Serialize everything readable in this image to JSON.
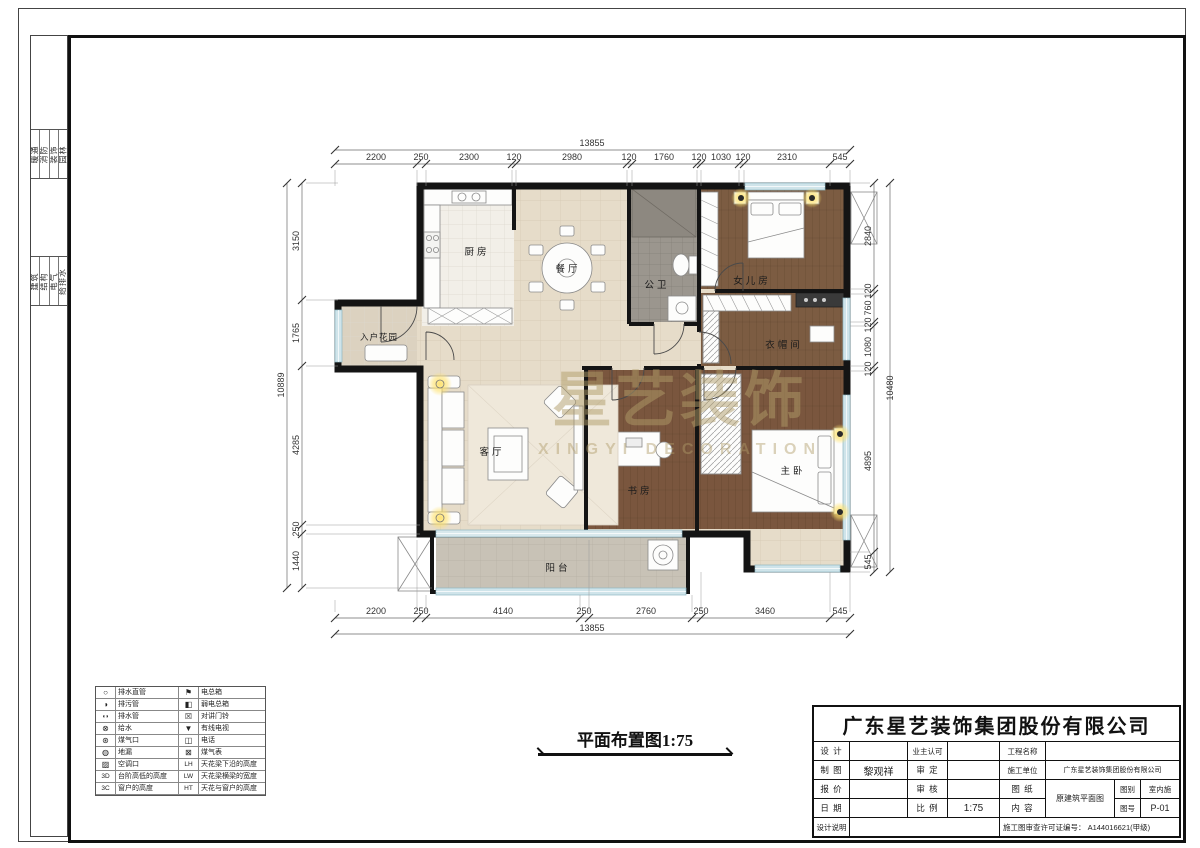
{
  "page": {
    "title_caption": "平面布置图1:75"
  },
  "watermark": {
    "cn": "星艺装饰",
    "en": "XINGYI DECORATION"
  },
  "rooms": {
    "kitchen": "厨房",
    "dining": "餐厅",
    "bath": "公卫",
    "girls_room": "女儿房",
    "cloak": "衣帽间",
    "master": "主卧",
    "study": "书房",
    "living": "客厅",
    "entry_garden": "入户花园",
    "balcony": "阳台"
  },
  "dims": {
    "top": {
      "total": "13855",
      "segments": [
        "2200",
        "250",
        "2300",
        "120",
        "2980",
        "120",
        "1760",
        "120",
        "1030",
        "120",
        "2310",
        "545"
      ]
    },
    "bottom": {
      "total": "13855",
      "segments": [
        "2200",
        "250",
        "4140",
        "250",
        "2760",
        "250",
        "3460",
        "545"
      ]
    },
    "left": {
      "total": "10889",
      "segments": [
        "3150",
        "1765",
        "4285",
        "250",
        "1440"
      ]
    },
    "right": {
      "total": "10480",
      "segments": [
        "2840",
        "120",
        "760",
        "120",
        "1080",
        "120",
        "4895",
        "545"
      ]
    }
  },
  "legend": {
    "left": [
      {
        "icon": "○",
        "label": "排水直管"
      },
      {
        "icon": "◑",
        "label": "排污管"
      },
      {
        "icon": "◖◗",
        "label": "排水管"
      },
      {
        "icon": "⊗",
        "label": "给水"
      },
      {
        "icon": "⊛",
        "label": "煤气口"
      },
      {
        "icon": "◍",
        "label": "地漏"
      },
      {
        "icon": "▨",
        "label": "空调口"
      },
      {
        "icon": "3D",
        "label": "台阶高低的高度"
      },
      {
        "icon": "3C",
        "label": "窗户的高度"
      }
    ],
    "right": [
      {
        "icon": "⚑",
        "label": "电总箱"
      },
      {
        "icon": "◧",
        "label": "弱电总箱"
      },
      {
        "icon": "☒",
        "label": "对讲门铃"
      },
      {
        "icon": "▼",
        "label": "有线电视"
      },
      {
        "icon": "◫",
        "label": "电话"
      },
      {
        "icon": "⊠",
        "label": "煤气表"
      },
      {
        "icon": "LH",
        "label": "天花梁下沿的高度"
      },
      {
        "icon": "LW",
        "label": "天花梁横梁的宽度"
      },
      {
        "icon": "HT",
        "label": "天花与窗户的高度"
      }
    ]
  },
  "frame_strip": {
    "group1": [
      "暖通",
      "消防",
      "装饰",
      "园林"
    ],
    "group2": [
      "建筑",
      "结构",
      "电气",
      "给排水"
    ]
  },
  "title_block": {
    "company": "广东星艺装饰集团股份有限公司",
    "labels": {
      "design": "设 计",
      "draft": "制 图",
      "quote": "报 价",
      "date": "日 期",
      "notes": "设计说明",
      "owner_ok": "业主认可",
      "approve": "审 定",
      "check": "审 核",
      "scale": "比 例",
      "project": "工程名称",
      "builder": "施工单位",
      "sheet": "图 纸",
      "content": "内 容",
      "category": "图别",
      "number": "图号"
    },
    "values": {
      "draft_name": "黎观祥",
      "scale": "1:75",
      "builder": "广东星艺装饰集团股份有限公司",
      "sheet_content": "原建筑平面图",
      "category": "室内施",
      "number": "P-01",
      "permit": "施工图审查许可证编号： A144016621(甲级)"
    }
  },
  "colors": {
    "wall": "#141414",
    "floor_tile": "#e6dcc9",
    "wood": "#7a573e",
    "bath": "#9b968e",
    "window": "#cfe4ea",
    "glow": "#ffe26b",
    "watermark": "#b09b68"
  }
}
